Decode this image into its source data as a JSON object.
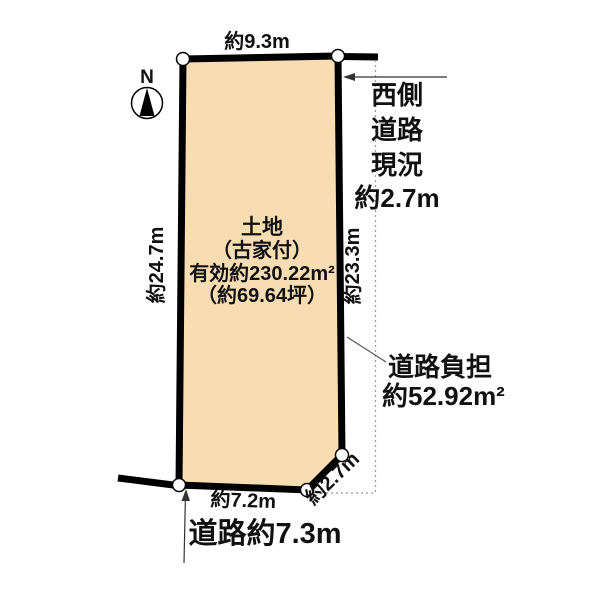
{
  "colors": {
    "plot_fill": "#F8DDB2",
    "outline": "#000000",
    "leader": "#444444",
    "dotted": "#9a9a9a"
  },
  "compass": {
    "label": "N"
  },
  "plot_label": {
    "line1": "土地",
    "line2": "（古家付）",
    "line3": "有効約230.22m²",
    "line4": "（約69.64坪）"
  },
  "dimensions": {
    "top": "約9.3m",
    "left": "約24.7m",
    "right": "約23.3m",
    "bottom": "約7.2m",
    "corner": "約2.7m"
  },
  "west_road": {
    "line1": "西側",
    "line2": "道路",
    "line3": "現況",
    "line4": "約2.7m"
  },
  "road_burden": {
    "line1": "道路負担",
    "line2": "約52.92m²"
  },
  "bottom_road": {
    "label": "道路約7.3m"
  }
}
